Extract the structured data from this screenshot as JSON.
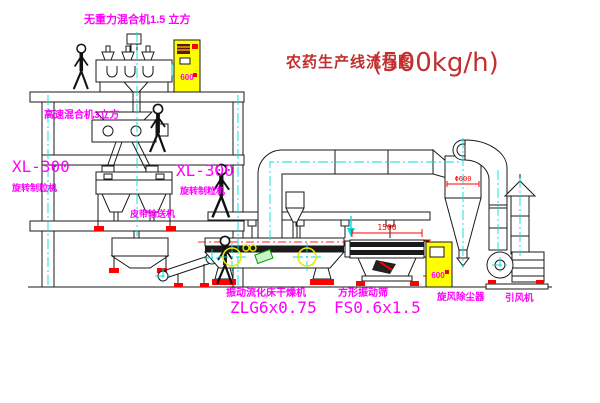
{
  "title": {
    "name": "农药生产线流程图",
    "capacity": "(500kg/h)"
  },
  "equipment": {
    "gravity_free_mixer": {
      "label": "无重力混合机1.5 立方"
    },
    "high_speed_mixer": {
      "label": "高速混合机3立方"
    },
    "granulator_left": {
      "model": "XL-300",
      "name": "旋转制粒机"
    },
    "granulator_center": {
      "model": "XL-300",
      "name": "旋转制粒机"
    },
    "belt_conveyor": {
      "name": "皮带输送机"
    },
    "fluid_bed_dryer": {
      "name": "振动流化床干燥机",
      "model": "ZLG6x0.75"
    },
    "square_vibrating_screen": {
      "name": "方形振动筛",
      "model": "FS0.6x1.5"
    },
    "cyclone": {
      "name": "旋风除尘器",
      "diameter": "Φ600"
    },
    "induced_draft_fan": {
      "name": "引风机"
    }
  },
  "dimensions": {
    "screen_length": "1500",
    "screen_height": "540"
  },
  "control_cabinets": {
    "cabinet_top": "600",
    "cabinet_right": "600"
  },
  "colors": {
    "label_magenta": "#ff00ff",
    "title_red": "#c22f2f",
    "dimension_red": "#ff0000",
    "centerline_cyan": "#00dede",
    "cabinet_yellow": "#ffff00"
  }
}
